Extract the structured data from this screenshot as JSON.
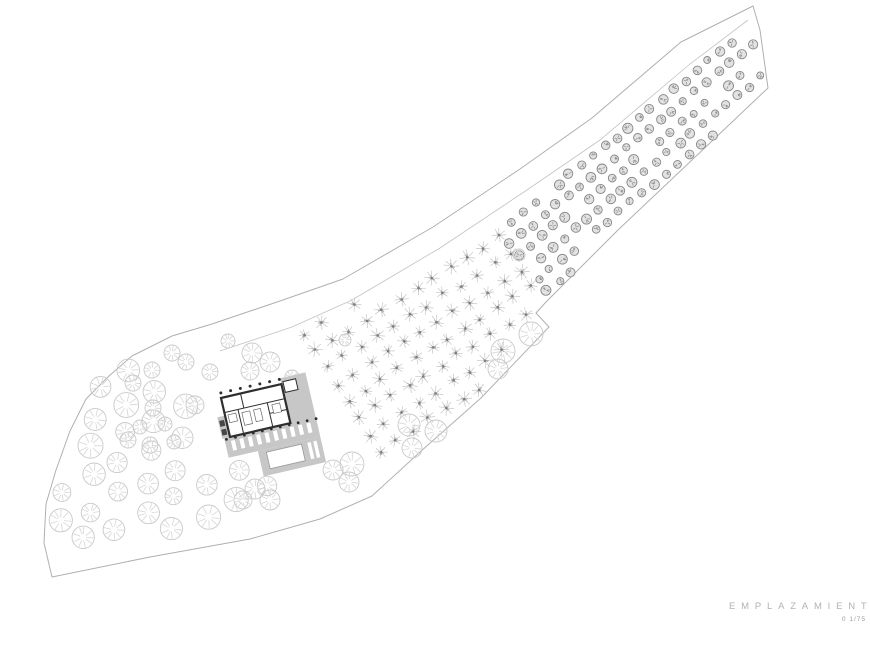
{
  "title_block": {
    "title": "EMPLAZAMIENTO",
    "scale": "0 1/75",
    "title_color": "#b2b2b2",
    "scale_color": "#9c9c9c"
  },
  "drawing": {
    "canvas": {
      "w": 870,
      "h": 652,
      "bg": "#ffffff"
    },
    "styles": {
      "boundary": {
        "stroke": "#b0b0b0",
        "width": 1
      },
      "track": {
        "stroke": "#c3c3c3",
        "width": 0.8
      },
      "big_tree": {
        "ring": "#c9c9c9",
        "spoke": "#d6d6d6"
      },
      "almond": {
        "twig": "#c6c6c6",
        "twig2": "#a9a9a9",
        "dot": "#7d7d7d"
      },
      "olive": {
        "stroke": "#868686",
        "fill": "#e2e2e2",
        "tick": "#8c8c8c"
      },
      "building": {
        "wall": "#2e2e2e",
        "terrace": "#c7c7c7",
        "detail": "#6a6a6a",
        "dark": "#474747",
        "pool_stroke": "#9a9a9a"
      }
    },
    "boundary_pts": [
      [
        753,
        6
      ],
      [
        760,
        30
      ],
      [
        768,
        88
      ],
      [
        618,
        230
      ],
      [
        546,
        302
      ],
      [
        536,
        313
      ],
      [
        549,
        327
      ],
      [
        481,
        398
      ],
      [
        420,
        452
      ],
      [
        372,
        496
      ],
      [
        320,
        519
      ],
      [
        250,
        539
      ],
      [
        150,
        557
      ],
      [
        52,
        577
      ],
      [
        44,
        543
      ],
      [
        46,
        504
      ],
      [
        56,
        470
      ],
      [
        70,
        431
      ],
      [
        86,
        399
      ],
      [
        109,
        376
      ],
      [
        132,
        356
      ],
      [
        172,
        336
      ],
      [
        212,
        324
      ],
      [
        280,
        301
      ],
      [
        343,
        279
      ],
      [
        433,
        227
      ],
      [
        520,
        169
      ],
      [
        592,
        118
      ],
      [
        681,
        42
      ]
    ],
    "track_pts": [
      [
        220,
        351
      ],
      [
        292,
        327
      ],
      [
        352,
        300
      ],
      [
        440,
        248
      ],
      [
        527,
        190
      ],
      [
        600,
        140
      ],
      [
        690,
        64
      ],
      [
        748,
        20
      ]
    ],
    "groves": {
      "olive": {
        "polygon": [
          [
            496,
            228
          ],
          [
            744,
            28
          ],
          [
            762,
            40
          ],
          [
            764,
            88
          ],
          [
            618,
            226
          ],
          [
            545,
            298
          ],
          [
            522,
            294
          ]
        ],
        "origin": [
          500,
          232
        ],
        "col_step": [
          11.6,
          -9.5
        ],
        "row_step": [
          9.5,
          11.6
        ],
        "cols": 23,
        "rows": 8,
        "jitter": 1.6,
        "radius": 4.3,
        "radius_var": 0.8,
        "skip": 0.12,
        "seed": 7
      },
      "almond": {
        "polygon": [
          [
            292,
            336
          ],
          [
            315,
            303
          ],
          [
            365,
            297
          ],
          [
            448,
            258
          ],
          [
            506,
            226
          ],
          [
            540,
            306
          ],
          [
            548,
            324
          ],
          [
            472,
            398
          ],
          [
            430,
            438
          ],
          [
            362,
            458
          ],
          [
            300,
            430
          ]
        ],
        "origin": [
          296,
          318
        ],
        "col_step": [
          16.6,
          -10.4
        ],
        "row_step": [
          10.4,
          16.6
        ],
        "cols": 13,
        "rows": 9,
        "jitter": 2.2,
        "radius": 7,
        "radius_var": 1,
        "skip": 0.05,
        "seed": 11
      },
      "fan": {
        "polygon": [
          [
            48,
            574
          ],
          [
            44,
            540
          ],
          [
            47,
            502
          ],
          [
            58,
            467
          ],
          [
            72,
            428
          ],
          [
            88,
            397
          ],
          [
            112,
            374
          ],
          [
            136,
            356
          ],
          [
            163,
            382
          ],
          [
            205,
            422
          ],
          [
            252,
            456
          ],
          [
            290,
            482
          ],
          [
            262,
            504
          ],
          [
            212,
            525
          ],
          [
            152,
            543
          ],
          [
            96,
            560
          ]
        ],
        "origin": [
          55,
          585
        ],
        "col_step": [
          30,
          -14
        ],
        "row_step": [
          2,
          -31
        ],
        "cols": 9,
        "rows": 8,
        "jitter": 4,
        "radius": 10.5,
        "radius_var": 2,
        "skip": 0.08,
        "seed": 23
      }
    },
    "scattered": [
      [
        172,
        353,
        8
      ],
      [
        152,
        370,
        8
      ],
      [
        133,
        383,
        8
      ],
      [
        195,
        405,
        9
      ],
      [
        153,
        408,
        8
      ],
      [
        140,
        427,
        7
      ],
      [
        165,
        424,
        7
      ],
      [
        128,
        440,
        8
      ],
      [
        150,
        445,
        8
      ],
      [
        174,
        442,
        7
      ],
      [
        186,
        362,
        8
      ],
      [
        210,
        372,
        8
      ],
      [
        228,
        341,
        7
      ],
      [
        252,
        353,
        10
      ],
      [
        270,
        362,
        10
      ],
      [
        250,
        371,
        9
      ],
      [
        292,
        377,
        7
      ],
      [
        302,
        390,
        6
      ],
      [
        345,
        340,
        6
      ],
      [
        519,
        255,
        6
      ],
      [
        352,
        464,
        12
      ],
      [
        333,
        470,
        10
      ],
      [
        349,
        482,
        10
      ],
      [
        409,
        425,
        11
      ],
      [
        436,
        431,
        11
      ],
      [
        412,
        448,
        10
      ],
      [
        531,
        334,
        12
      ],
      [
        503,
        351,
        12
      ],
      [
        498,
        369,
        10
      ],
      [
        255,
        489,
        10
      ],
      [
        270,
        500,
        10
      ],
      [
        243,
        500,
        9
      ]
    ],
    "building": {
      "translate": [
        221,
        398
      ],
      "rotate": -13,
      "terrace_rects": [
        [
          62,
          -6,
          26,
          64
        ],
        [
          -6,
          40,
          94,
          20
        ],
        [
          24,
          60,
          64,
          26
        ],
        [
          -8,
          18,
          8,
          22
        ]
      ],
      "pool": [
        32,
        63,
        36,
        17
      ],
      "loungers": {
        "start": [
          0,
          44
        ],
        "count": 10,
        "step": 8.6,
        "size": [
          4,
          10
        ]
      },
      "wing_ticks": {
        "start": [
          74,
          63
        ],
        "count": 2,
        "step": 6,
        "size": [
          3.5,
          17
        ]
      },
      "house": [
        0,
        0,
        62,
        40
      ],
      "inner_walls": [
        [
          0,
          15,
          62,
          15
        ],
        [
          20,
          0,
          20,
          15
        ],
        [
          14,
          15,
          14,
          40
        ],
        [
          44,
          15,
          44,
          40
        ],
        [
          44,
          26,
          62,
          26
        ]
      ],
      "furniture": [
        [
          17,
          19,
          8,
          13
        ],
        [
          29,
          19,
          7,
          12
        ],
        [
          48,
          18,
          8,
          9
        ],
        [
          3,
          18,
          8,
          8
        ]
      ],
      "upper_room": [
        64,
        -2,
        13,
        11
      ],
      "dark_rects": [
        [
          -7,
          22,
          5,
          6
        ],
        [
          -7,
          31,
          5,
          6
        ]
      ],
      "column_rows": [
        {
          "y": -5,
          "x0": 1,
          "count": 7,
          "step": 10,
          "r": 1.5
        },
        {
          "y": 41.5,
          "x0": -4,
          "count": 11,
          "step": 9.2,
          "r": 1.4
        }
      ]
    }
  }
}
